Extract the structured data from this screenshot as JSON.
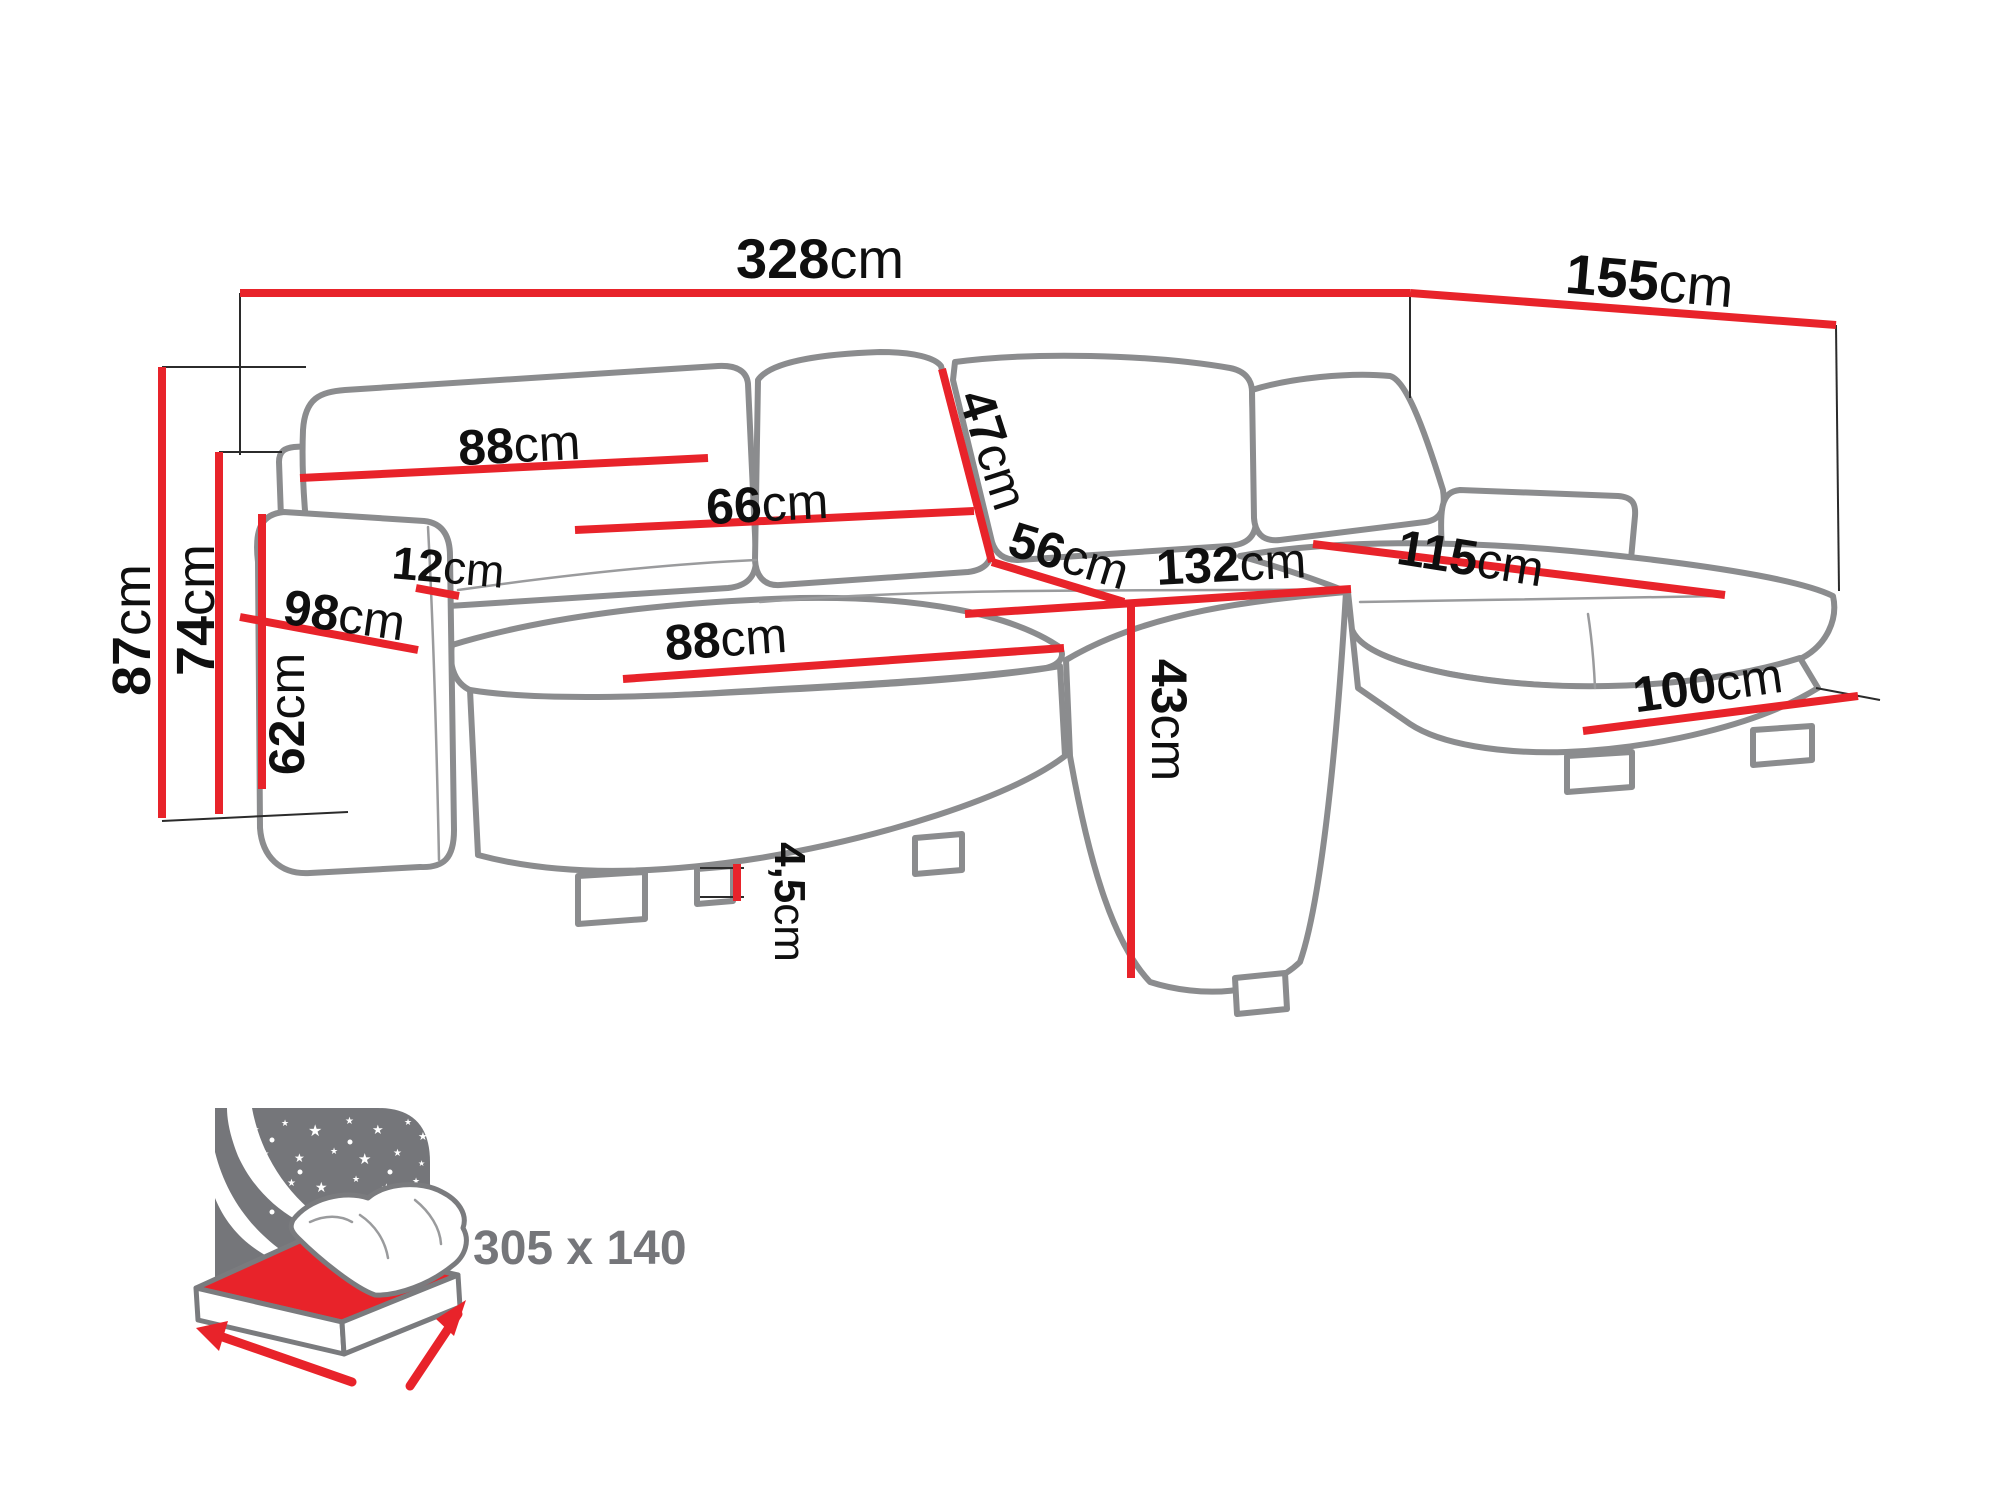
{
  "figure": {
    "type": "furniture-dimension-diagram",
    "subject": "u-shaped corner sofa with sleeping function",
    "unit": "cm",
    "colors": {
      "dimension_line": "#e8232a",
      "sofa_outline": "#8b8c8e",
      "icon_gray": "#75767a",
      "label_text": "#0f0f0f",
      "background": "#ffffff"
    },
    "dimensions": {
      "total_width": {
        "value": "328",
        "unit": "cm"
      },
      "right_depth": {
        "value": "155",
        "unit": "cm"
      },
      "total_height": {
        "value": "87",
        "unit": "cm"
      },
      "backrest_height": {
        "value": "74",
        "unit": "cm"
      },
      "armrest_height": {
        "value": "62",
        "unit": "cm"
      },
      "left_depth": {
        "value": "98",
        "unit": "cm"
      },
      "armrest_width": {
        "value": "12",
        "unit": "cm"
      },
      "back_cushion_width": {
        "value": "88",
        "unit": "cm"
      },
      "middle_back_cushion_width": {
        "value": "66",
        "unit": "cm"
      },
      "back_cushion_height": {
        "value": "47",
        "unit": "cm"
      },
      "seat_depth": {
        "value": "56",
        "unit": "cm"
      },
      "middle_section_width": {
        "value": "132",
        "unit": "cm"
      },
      "seat_height": {
        "value": "43",
        "unit": "cm"
      },
      "seat_width": {
        "value": "88",
        "unit": "cm"
      },
      "chaise_length": {
        "value": "115",
        "unit": "cm"
      },
      "chaise_width": {
        "value": "100",
        "unit": "cm"
      },
      "leg_height": {
        "value": "4,5",
        "unit": "cm"
      }
    },
    "sleeping_area": {
      "label": "305 x 140"
    }
  }
}
